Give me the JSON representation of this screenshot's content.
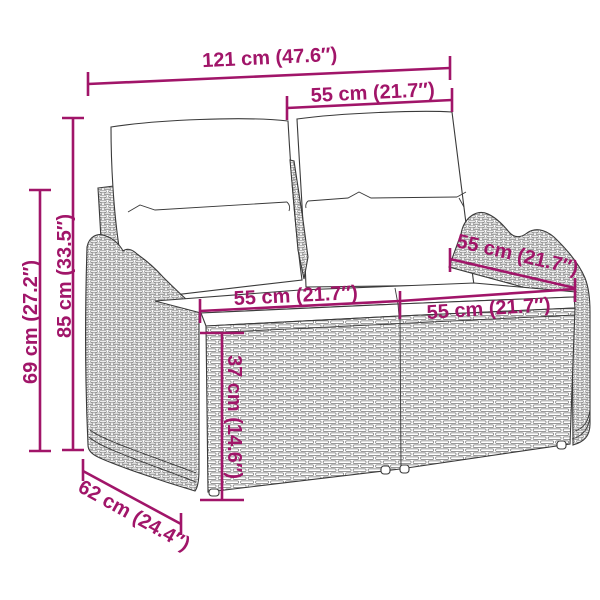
{
  "diagram": {
    "type": "product-dimension-diagram",
    "subject": "2-seater rattan garden bench with back and seat cushions"
  },
  "colors": {
    "accent": "#A11569",
    "outline": "#3a3a3a",
    "weave": "#777777",
    "background": "#ffffff"
  },
  "measurements": {
    "overall_width": {
      "label": "121 cm (47.6″)"
    },
    "backrest_width": {
      "label": "55 cm (21.7″)"
    },
    "overall_height": {
      "label": "85 cm (33.5″)"
    },
    "armrest_height": {
      "label": "69 cm (27.2″)"
    },
    "seat_width_left": {
      "label": "55 cm (21.7″)"
    },
    "seat_width_right": {
      "label": "55 cm (21.7″)"
    },
    "seat_depth": {
      "label": "55 cm (21.7″)"
    },
    "seat_height": {
      "label": "37 cm (14.6″)"
    },
    "overall_depth": {
      "label": "62 cm (24.4″)"
    }
  }
}
